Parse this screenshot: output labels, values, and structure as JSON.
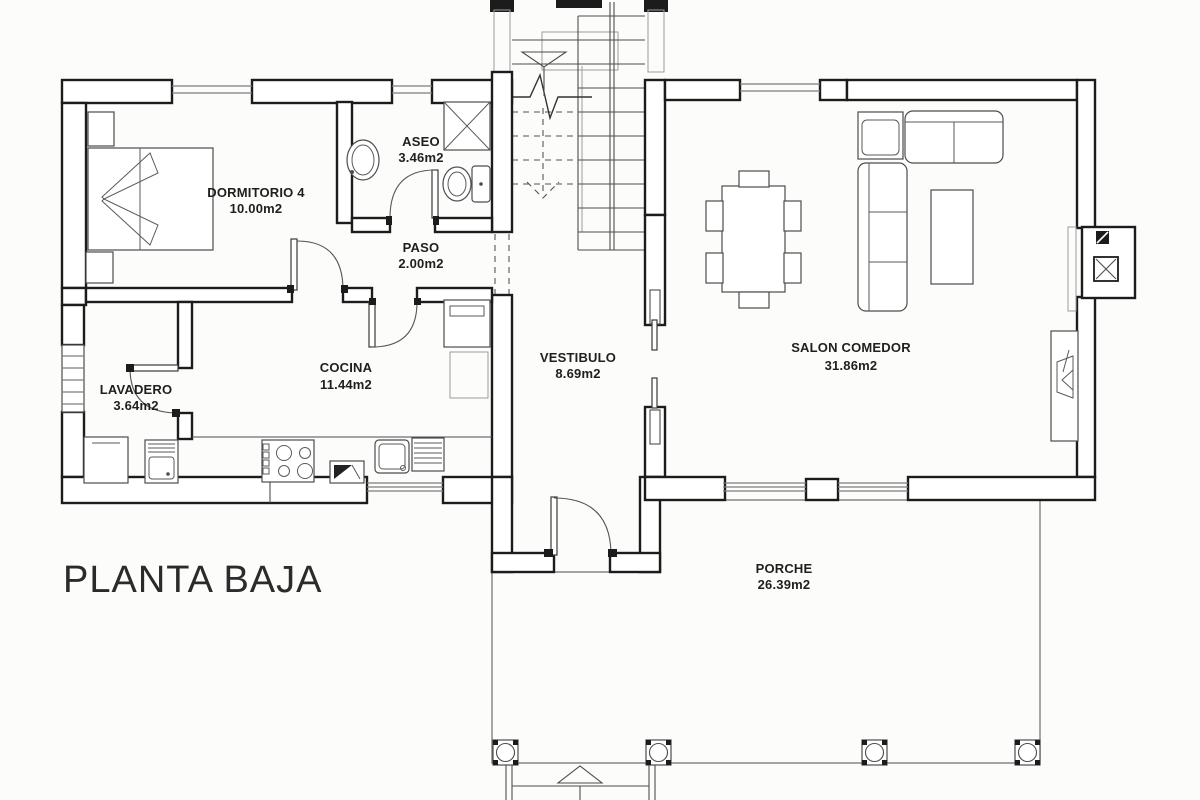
{
  "title": "PLANTA BAJA",
  "rooms": {
    "dormitorio4": {
      "name": "DORMITORIO 4",
      "area": "10.00m2"
    },
    "aseo": {
      "name": "ASEO",
      "area": "3.46m2"
    },
    "paso": {
      "name": "PASO",
      "area": "2.00m2"
    },
    "lavadero": {
      "name": "LAVADERO",
      "area": "3.64m2"
    },
    "cocina": {
      "name": "COCINA",
      "area": "11.44m2"
    },
    "vestibulo": {
      "name": "VESTIBULO",
      "area": "8.69m2"
    },
    "salon": {
      "name": "SALON COMEDOR",
      "area": "31.86m2"
    },
    "porche": {
      "name": "PORCHE",
      "area": "26.39m2"
    }
  },
  "colors": {
    "walls": "#1c1c1c",
    "furniture": "#4d4d4d",
    "tile_grid": "#8f8f8f",
    "paper": "#fcfcfa",
    "text": "#1f1f1f"
  }
}
